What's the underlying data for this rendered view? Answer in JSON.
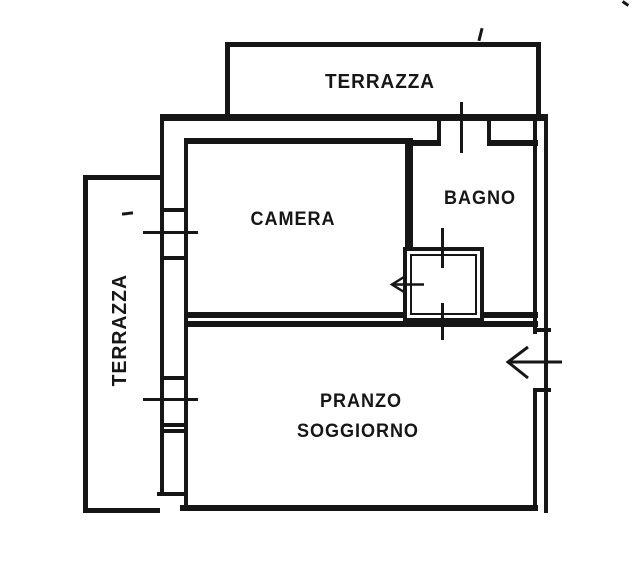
{
  "document": {
    "colors": {
      "ink": "#161616",
      "paper": "#ffffff"
    },
    "labels": {
      "terrace_top": "TERRAZZA",
      "terrace_left": "TERRAZZA",
      "bedroom": "CAMERA",
      "bathroom": "BAGNO",
      "living_dining_line1": "PRANZO",
      "living_dining_line2": "SOGGIORNO"
    }
  }
}
